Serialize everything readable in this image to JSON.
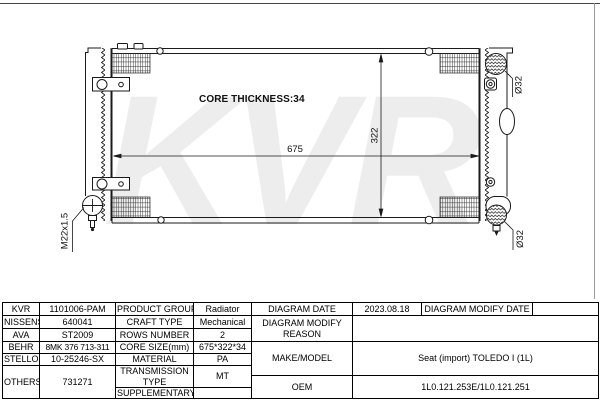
{
  "watermark": "KVR",
  "diagram": {
    "core_thickness_label": "CORE THICKNESS:34",
    "dim_width": "675",
    "dim_height": "322",
    "drain_label": "M22x1.5",
    "inlet_label": "Ø32",
    "outlet_label": "Ø32"
  },
  "table": {
    "rows": [
      {
        "brand": "KVR",
        "number": "1101006-PAM"
      },
      {
        "brand": "NISSENS",
        "number": "640041"
      },
      {
        "brand": "AVA",
        "number": "ST2009"
      },
      {
        "brand": "BEHR",
        "number": "8MK 376 713-311"
      },
      {
        "brand": "STELLOX",
        "number": "10-25246-SX"
      },
      {
        "brand": "OTHERS",
        "number": "731271"
      }
    ],
    "specs": [
      {
        "label": "PRODUCT GROUP",
        "value": "Radiator"
      },
      {
        "label": "CRAFT TYPE",
        "value": "Mechanical"
      },
      {
        "label": "ROWS NUMBER",
        "value": "2"
      },
      {
        "label": "CORE SIZE(mm)",
        "value": "675*322*34"
      },
      {
        "label": "MATERIAL",
        "value": "PA"
      },
      {
        "label": "TRANSMISSION TYPE",
        "value": "MT"
      },
      {
        "label": "SUPPLEMENTARY",
        "value": ""
      }
    ],
    "right": {
      "diagram_date_label": "DIAGRAM DATE",
      "diagram_date": "2023.08.18",
      "diagram_modify_date_label": "DIAGRAM MODIFY DATE",
      "diagram_modify_date": "",
      "diagram_modify_reason_label": "DIAGRAM MODIFY REASON",
      "diagram_modify_reason": "",
      "make_model_label": "MAKE/MODEL",
      "make_model": "Seat (import) TOLEDO I (1L)",
      "oem_label": "OEM",
      "oem": "1L0.121.253E/1L0.121.251"
    }
  }
}
